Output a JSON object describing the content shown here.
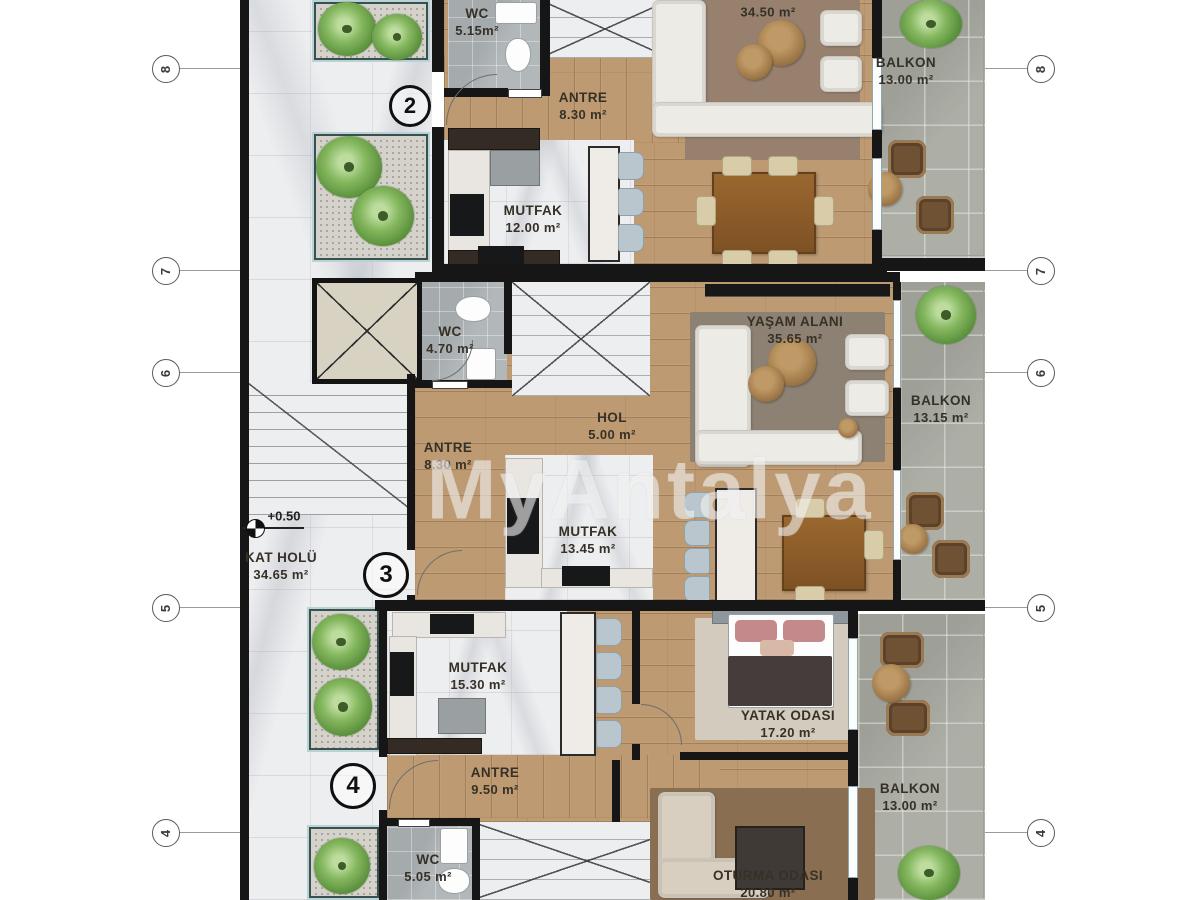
{
  "watermark": "MyAntalya",
  "level_marker": "+0.50",
  "unit_markers": [
    "2",
    "3",
    "4"
  ],
  "grid_markers": [
    "8",
    "7",
    "6",
    "5",
    "4"
  ],
  "rooms": {
    "wc_top": {
      "name": "WC",
      "area": "5.15m²"
    },
    "antre_top": {
      "name": "ANTRE",
      "area": "8.30 m²"
    },
    "living_top": {
      "area": "34.50 m²"
    },
    "balkon_top": {
      "name": "BALKON",
      "area": "13.00 m²"
    },
    "mutfak_top": {
      "name": "MUTFAK",
      "area": "12.00 m²"
    },
    "wc_mid": {
      "name": "WC",
      "area": "4.70 m²"
    },
    "hol": {
      "name": "HOL",
      "area": "5.00 m²"
    },
    "antre_mid": {
      "name": "ANTRE",
      "area": "8.30 m²"
    },
    "living_mid": {
      "name": "YAŞAM ALANI",
      "area": "35.65 m²"
    },
    "balkon_mid": {
      "name": "BALKON",
      "area": "13.15 m²"
    },
    "mutfak_mid": {
      "name": "MUTFAK",
      "area": "13.45 m²"
    },
    "kat_holu": {
      "name": "KAT HOLÜ",
      "area": "34.65 m²"
    },
    "mutfak_bottom": {
      "name": "MUTFAK",
      "area": "15.30 m²"
    },
    "yatak_odasi": {
      "name": "YATAK ODASI",
      "area": "17.20 m²"
    },
    "antre_bottom": {
      "name": "ANTRE",
      "area": "9.50 m²"
    },
    "balkon_bottom": {
      "name": "BALKON",
      "area": "13.00 m²"
    },
    "wc_bottom": {
      "name": "WC",
      "area": "5.05 m²"
    },
    "oturma_odasi": {
      "name": "OTURMA ODASI",
      "area": "20.80 m²"
    }
  },
  "colors": {
    "wall": "#161616",
    "wood_floor": "#bd9a72",
    "marble": "#edeef0",
    "balcony_stone": "#adafa7",
    "wc_tile": "#b2b7b9",
    "plant_green": "#7fb35b",
    "rug_brown": "#97806e",
    "label_text": "#363127"
  }
}
